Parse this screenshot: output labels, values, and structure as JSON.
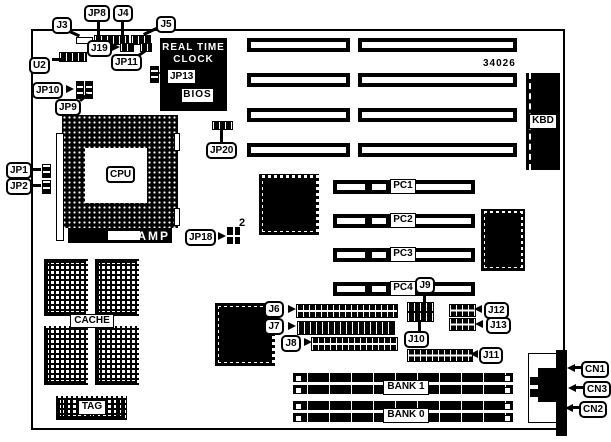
{
  "colors": {
    "background": "#ffffff",
    "ink": "#000000"
  },
  "board": {
    "part_number": "34026"
  },
  "callouts": {
    "j3": "J3",
    "jp8": "JP8",
    "j4": "J4",
    "j5": "J5",
    "j19": "J19",
    "jp11": "JP11",
    "u2": "U2",
    "jp13": "JP13",
    "jp10": "JP10",
    "jp9": "JP9",
    "jp1": "JP1",
    "jp2": "JP2",
    "jp20": "JP20",
    "jp18": "JP18",
    "j6": "J6",
    "j7": "J7",
    "j8": "J8",
    "j9": "J9",
    "j10": "J10",
    "j11": "J11",
    "j12": "J12",
    "j13": "J13",
    "cn1": "CN1",
    "cn3": "CN3",
    "cn2": "CN2"
  },
  "components": {
    "rtc_line1": "REAL TIME",
    "rtc_line2": "CLOCK",
    "bios": "BIOS",
    "kbd": "KBD",
    "cpu": "CPU",
    "amp": "AMP",
    "cache": "CACHE",
    "tag": "TAG",
    "bank1": "BANK 1",
    "bank0": "BANK 0",
    "pc1": "PC1",
    "pc2": "PC2",
    "pc3": "PC3",
    "pc4": "PC4"
  },
  "annotations": {
    "jp18_pins": "2"
  }
}
